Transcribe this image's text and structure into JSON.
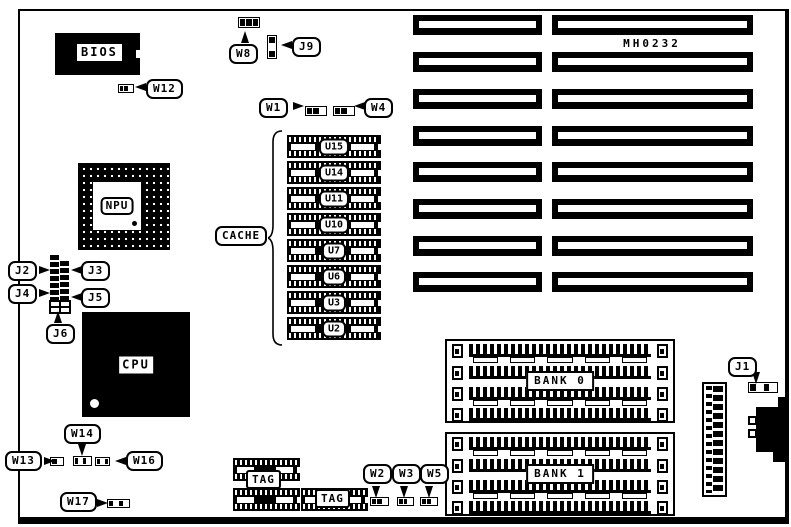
{
  "diagram": {
    "part_number": "MH0232",
    "chips": {
      "bios": "BIOS",
      "npu": "NPU",
      "cpu": "CPU",
      "cache_label": "CACHE",
      "cache_units": [
        "U15",
        "U14",
        "U11",
        "U10",
        "U7",
        "U6",
        "U3",
        "U2"
      ],
      "tag_left": "TAG",
      "tag_right": "TAG"
    },
    "memory_banks": [
      {
        "label": "BANK 0"
      },
      {
        "label": "BANK 1"
      }
    ],
    "expansion_slots": {
      "rows": 8,
      "columns": 2
    },
    "callouts": [
      {
        "id": "W1",
        "label": "W1"
      },
      {
        "id": "W2",
        "label": "W2"
      },
      {
        "id": "W3",
        "label": "W3"
      },
      {
        "id": "W4",
        "label": "W4"
      },
      {
        "id": "W5",
        "label": "W5"
      },
      {
        "id": "W8",
        "label": "W8"
      },
      {
        "id": "W12",
        "label": "W12"
      },
      {
        "id": "W13",
        "label": "W13"
      },
      {
        "id": "W14",
        "label": "W14"
      },
      {
        "id": "W16",
        "label": "W16"
      },
      {
        "id": "W17",
        "label": "W17"
      },
      {
        "id": "J1",
        "label": "J1"
      },
      {
        "id": "J2",
        "label": "J2"
      },
      {
        "id": "J3",
        "label": "J3"
      },
      {
        "id": "J4",
        "label": "J4"
      },
      {
        "id": "J5",
        "label": "J5"
      },
      {
        "id": "J6",
        "label": "J6"
      },
      {
        "id": "J9",
        "label": "J9"
      }
    ],
    "colors": {
      "ink": "#000000",
      "paper": "#ffffff"
    }
  }
}
